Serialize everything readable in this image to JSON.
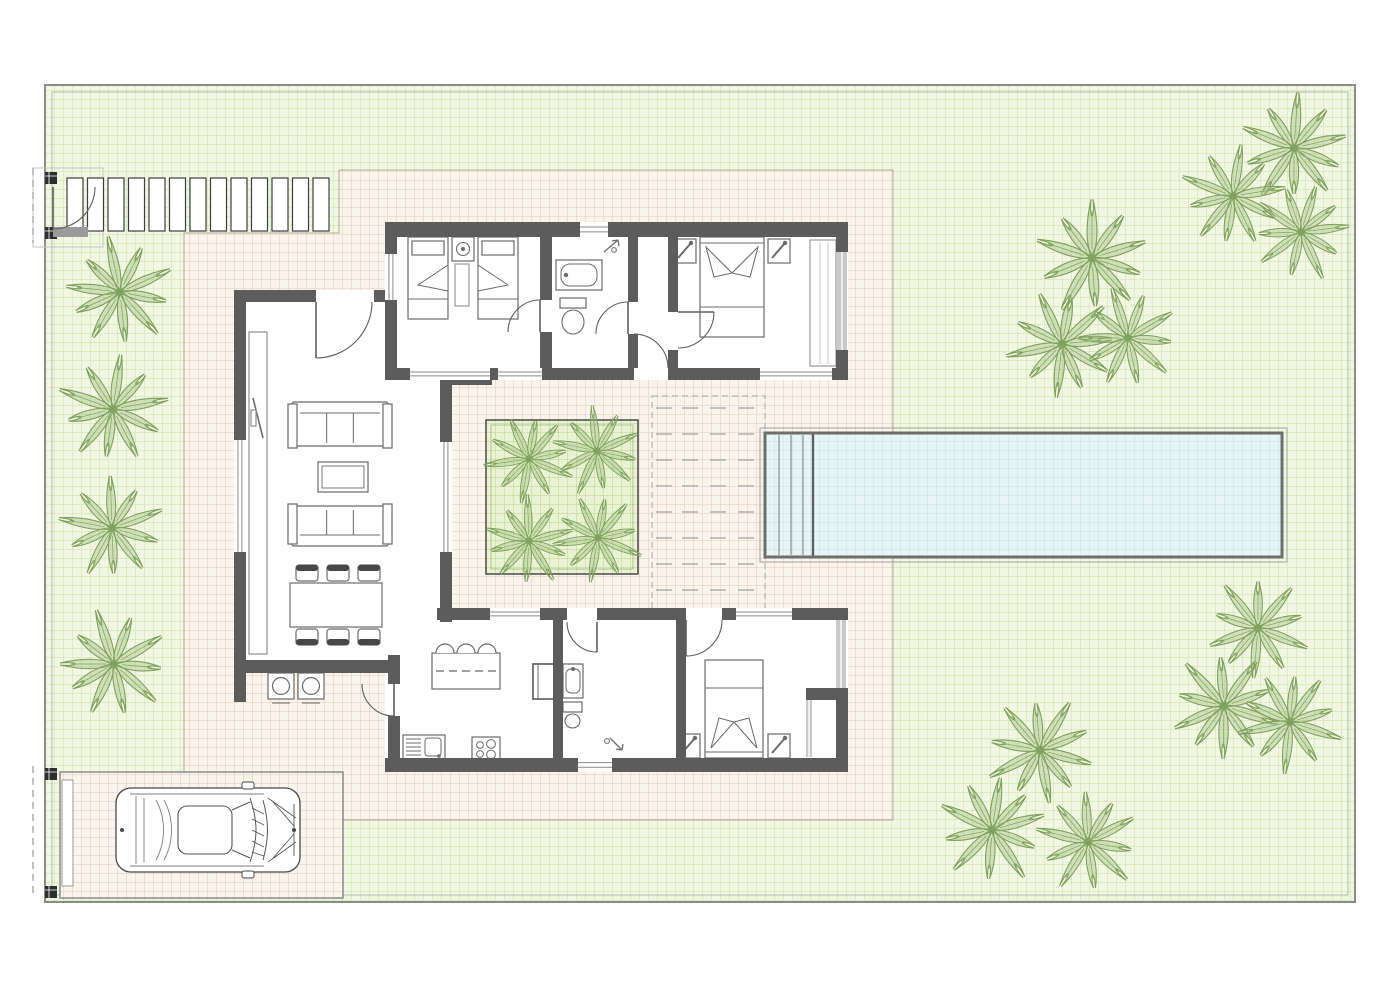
{
  "plan": {
    "kind": "villa-floor-plan-top-view",
    "canvas": [
      1400,
      990
    ]
  },
  "colors": {
    "page_bg": "#ffffff",
    "border_outer": "#8c8c8c",
    "border_inner": "#b5b5b5",
    "grass_base": "#f2f7e3",
    "grass_line": "#cbe0a6",
    "deck_base": "#faf4ed",
    "deck_line": "#ddcdbb",
    "deck_edge": "#b3a795",
    "planter_base": "#e9f3d4",
    "planter_line": "#b8d38c",
    "water_base": "#e8f5f7",
    "water_line": "#c5e2ea",
    "pool_rim": "#6e6e6e",
    "wall": "#5c5c5c",
    "wall_light": "#c9c9c9",
    "furniture_stroke": "#6b6b6b",
    "furniture_dark": "#474747",
    "palm_stroke": "#7fa05e",
    "palm_fill": "rgba(158,189,128,0.40)",
    "door_stroke": "#5f5f5f",
    "dash_gray": "#b3b3b3"
  },
  "plot": {
    "outer": [
      45,
      85,
      1310,
      817
    ],
    "inner_offset": 7
  },
  "deck_polygon": [
    [
      184,
      233
    ],
    [
      339,
      233
    ],
    [
      339,
      170
    ],
    [
      893,
      170
    ],
    [
      893,
      820
    ],
    [
      343,
      820
    ],
    [
      343,
      772
    ],
    [
      184,
      772
    ]
  ],
  "pool": {
    "rect": [
      765,
      433,
      517,
      124
    ],
    "outer_line_offset": 5,
    "step_lines_x": [
      779,
      791,
      803
    ],
    "divider_x": 813
  },
  "walkway": {
    "x": 67,
    "y": 178,
    "slat_w": 16,
    "slat_h": 53,
    "gap": 4.5,
    "count": 13,
    "pad_box": [
      33,
      168,
      70,
      79
    ]
  },
  "driveway": {
    "rect": [
      60,
      772,
      283,
      126
    ],
    "gate_leaf": [
      62,
      780,
      11,
      106
    ]
  },
  "gates": {
    "pedestrian": {
      "posts": [
        [
          45,
          172
        ],
        [
          45,
          227
        ]
      ],
      "post_size": 12,
      "dash_line": [
        33,
        168,
        33,
        243
      ],
      "stub": [
        53,
        227,
        35,
        10
      ]
    },
    "vehicle": {
      "posts": [
        [
          45,
          768
        ],
        [
          45,
          886
        ]
      ],
      "post_size": 12,
      "dash_line": [
        33,
        766,
        33,
        898
      ]
    }
  },
  "lounge_deck": {
    "outline": [
      652,
      396,
      113,
      228
    ],
    "row_y_start": 408,
    "row_step": 26,
    "row_count": 9,
    "dash_x": [
      656,
      682,
      710,
      738
    ],
    "dash_len": 16
  },
  "courtyard_planter": {
    "rect": [
      486,
      420,
      152,
      154
    ],
    "inner_offset": 5
  },
  "floors": [
    [
      385,
      222,
      463,
      158
    ],
    [
      234,
      290,
      218,
      383
    ],
    [
      385,
      608,
      463,
      164
    ]
  ],
  "walls": [
    [
      385,
      222,
      463,
      15
    ],
    [
      385,
      222,
      12,
      158
    ],
    [
      836,
      222,
      12,
      30
    ],
    [
      836,
      350,
      12,
      30
    ],
    [
      385,
      368,
      463,
      12
    ],
    [
      540,
      237,
      12,
      131
    ],
    [
      628,
      237,
      10,
      131
    ],
    [
      668,
      237,
      10,
      131
    ],
    [
      234,
      290,
      151,
      12
    ],
    [
      234,
      290,
      12,
      412
    ],
    [
      234,
      660,
      163,
      13
    ],
    [
      440,
      373,
      12,
      249
    ],
    [
      440,
      373,
      52,
      12
    ],
    [
      437,
      608,
      411,
      12
    ],
    [
      388,
      655,
      12,
      117
    ],
    [
      385,
      758,
      463,
      14
    ],
    [
      553,
      620,
      10,
      140
    ],
    [
      676,
      620,
      10,
      140
    ],
    [
      836,
      688,
      12,
      84
    ],
    [
      806,
      688,
      42,
      12
    ]
  ],
  "wall_openings": [
    [
      316,
      290,
      58,
      12
    ],
    [
      634,
      368,
      34,
      12
    ],
    [
      540,
      300,
      12,
      32
    ],
    [
      628,
      302,
      10,
      32
    ],
    [
      668,
      312,
      10,
      38
    ],
    [
      567,
      608,
      30,
      12
    ],
    [
      686,
      608,
      36,
      12
    ],
    [
      388,
      684,
      12,
      32
    ]
  ],
  "windows": [
    [
      580,
      222,
      28,
      15
    ],
    [
      385,
      254,
      12,
      46
    ],
    [
      410,
      368,
      80,
      12
    ],
    [
      498,
      368,
      44,
      12
    ],
    [
      760,
      368,
      72,
      12
    ],
    [
      234,
      440,
      12,
      112
    ],
    [
      440,
      442,
      12,
      110
    ],
    [
      490,
      608,
      50,
      12
    ],
    [
      736,
      608,
      56,
      12
    ],
    [
      578,
      758,
      34,
      14
    ]
  ],
  "glazing": [
    [
      837,
      252,
      10,
      98
    ],
    [
      836,
      620,
      10,
      68
    ],
    [
      806,
      700,
      6,
      57
    ]
  ],
  "thin_lines": [
    [
      820,
      242,
      820,
      364
    ],
    [
      828,
      242,
      828,
      364
    ]
  ],
  "doors": [
    {
      "c": [
        316,
        302
      ],
      "r": 56,
      "a0": 0,
      "a1": 90,
      "sweep": 1
    },
    {
      "c": [
        634,
        368
      ],
      "r": 34,
      "a0": 0,
      "a1": 270,
      "sweep": 0
    },
    {
      "c": [
        540,
        332
      ],
      "r": 32,
      "a0": 180,
      "a1": 270,
      "sweep": 1
    },
    {
      "c": [
        628,
        334
      ],
      "r": 32,
      "a0": 180,
      "a1": 270,
      "sweep": 1
    },
    {
      "c": [
        678,
        312
      ],
      "r": 36,
      "a0": 90,
      "a1": 0,
      "sweep": 0
    },
    {
      "c": [
        597,
        622
      ],
      "r": 30,
      "a0": 180,
      "a1": 90,
      "sweep": 0
    },
    {
      "c": [
        686,
        620
      ],
      "r": 36,
      "a0": 0,
      "a1": 90,
      "sweep": 1
    },
    {
      "c": [
        394,
        684
      ],
      "r": 32,
      "a0": 180,
      "a1": 90,
      "sweep": 0
    },
    {
      "c": [
        53,
        187
      ],
      "r": 42,
      "a0": 0,
      "a1": 90,
      "sweep": 1
    }
  ],
  "furniture": {
    "single_beds": [
      {
        "r": [
          408,
          237,
          40,
          82
        ],
        "fold": "right"
      },
      {
        "r": [
          478,
          237,
          40,
          82
        ],
        "fold": "left"
      }
    ],
    "double_beds": [
      {
        "r": [
          700,
          237,
          64,
          100
        ],
        "head": "top"
      },
      {
        "r": [
          705,
          660,
          58,
          98
        ],
        "head": "bottom"
      }
    ],
    "nightstands": [
      {
        "r": [
          452,
          237,
          22,
          24
        ],
        "lamp": "round"
      },
      {
        "r": [
          674,
          239,
          22,
          24
        ],
        "lamp": "diag"
      },
      {
        "r": [
          768,
          239,
          22,
          24
        ],
        "lamp": "diag"
      },
      {
        "r": [
          678,
          734,
          22,
          24
        ],
        "lamp": "diag"
      },
      {
        "r": [
          768,
          734,
          22,
          24
        ],
        "lamp": "diag"
      }
    ],
    "rug": [
      455,
      264,
      14,
      42
    ],
    "wardrobe": [
      810,
      240,
      26,
      126
    ],
    "tub": [
      556,
      260,
      46,
      30
    ],
    "toilets": [
      [
        560,
        298,
        26,
        34
      ],
      [
        563,
        702,
        19,
        24
      ]
    ],
    "vanities": [
      [
        562,
        298,
        0,
        0
      ]
    ],
    "vanity2": [
      563,
      664,
      20,
      34
    ],
    "shower_arrows": [
      {
        "x": 604,
        "y": 252,
        "dir": "ne"
      },
      {
        "x": 610,
        "y": 738,
        "dir": "se"
      }
    ],
    "sofas": [
      {
        "r": [
          292,
          402,
          96,
          44
        ],
        "back": "top"
      },
      {
        "r": [
          292,
          506,
          96,
          40
        ],
        "back": "bottom"
      }
    ],
    "coffee_table": [
      318,
      462,
      50,
      30
    ],
    "tv_unit": [
      249,
      332,
      18,
      322
    ],
    "dining_table": [
      290,
      583,
      92,
      44
    ],
    "chairs_top": [
      [
        296,
        565,
        22,
        16
      ],
      [
        327,
        565,
        22,
        16
      ],
      [
        358,
        565,
        22,
        16
      ]
    ],
    "chairs_bottom": [
      [
        296,
        629,
        22,
        16
      ],
      [
        327,
        629,
        22,
        16
      ],
      [
        358,
        629,
        22,
        16
      ]
    ],
    "island": [
      432,
      653,
      68,
      36
    ],
    "stools": [
      [
        445,
        653,
        9
      ],
      [
        466,
        653,
        9
      ],
      [
        487,
        653,
        9
      ]
    ],
    "sink_unit": [
      403,
      735,
      42,
      24
    ],
    "cooktop": [
      472,
      737,
      28,
      24
    ],
    "fridge": [
      533,
      664,
      27,
      35
    ],
    "ac_units": [
      [
        268,
        673,
        26,
        26
      ],
      [
        298,
        673,
        26,
        26
      ]
    ]
  },
  "car": {
    "x": 116,
    "y": 788,
    "w": 184,
    "h": 84
  },
  "palms": {
    "garden": [
      [
        120,
        292,
        1
      ],
      [
        113,
        409,
        1
      ],
      [
        112,
        528,
        0.95
      ],
      [
        114,
        664,
        1
      ],
      [
        1294,
        148,
        1
      ],
      [
        1233,
        196,
        0.95
      ],
      [
        1301,
        232,
        0.9
      ],
      [
        1092,
        258,
        1.05
      ],
      [
        1062,
        344,
        1
      ],
      [
        1128,
        338,
        0.92
      ],
      [
        1258,
        628,
        0.95
      ],
      [
        1224,
        706,
        1
      ],
      [
        1290,
        722,
        0.95
      ],
      [
        1040,
        750,
        1
      ],
      [
        992,
        830,
        1
      ],
      [
        1088,
        842,
        0.95
      ]
    ],
    "courtyard": [
      [
        529,
        459,
        0.82
      ],
      [
        597,
        451,
        0.82
      ],
      [
        529,
        541,
        0.82
      ],
      [
        598,
        538,
        0.82
      ]
    ]
  }
}
